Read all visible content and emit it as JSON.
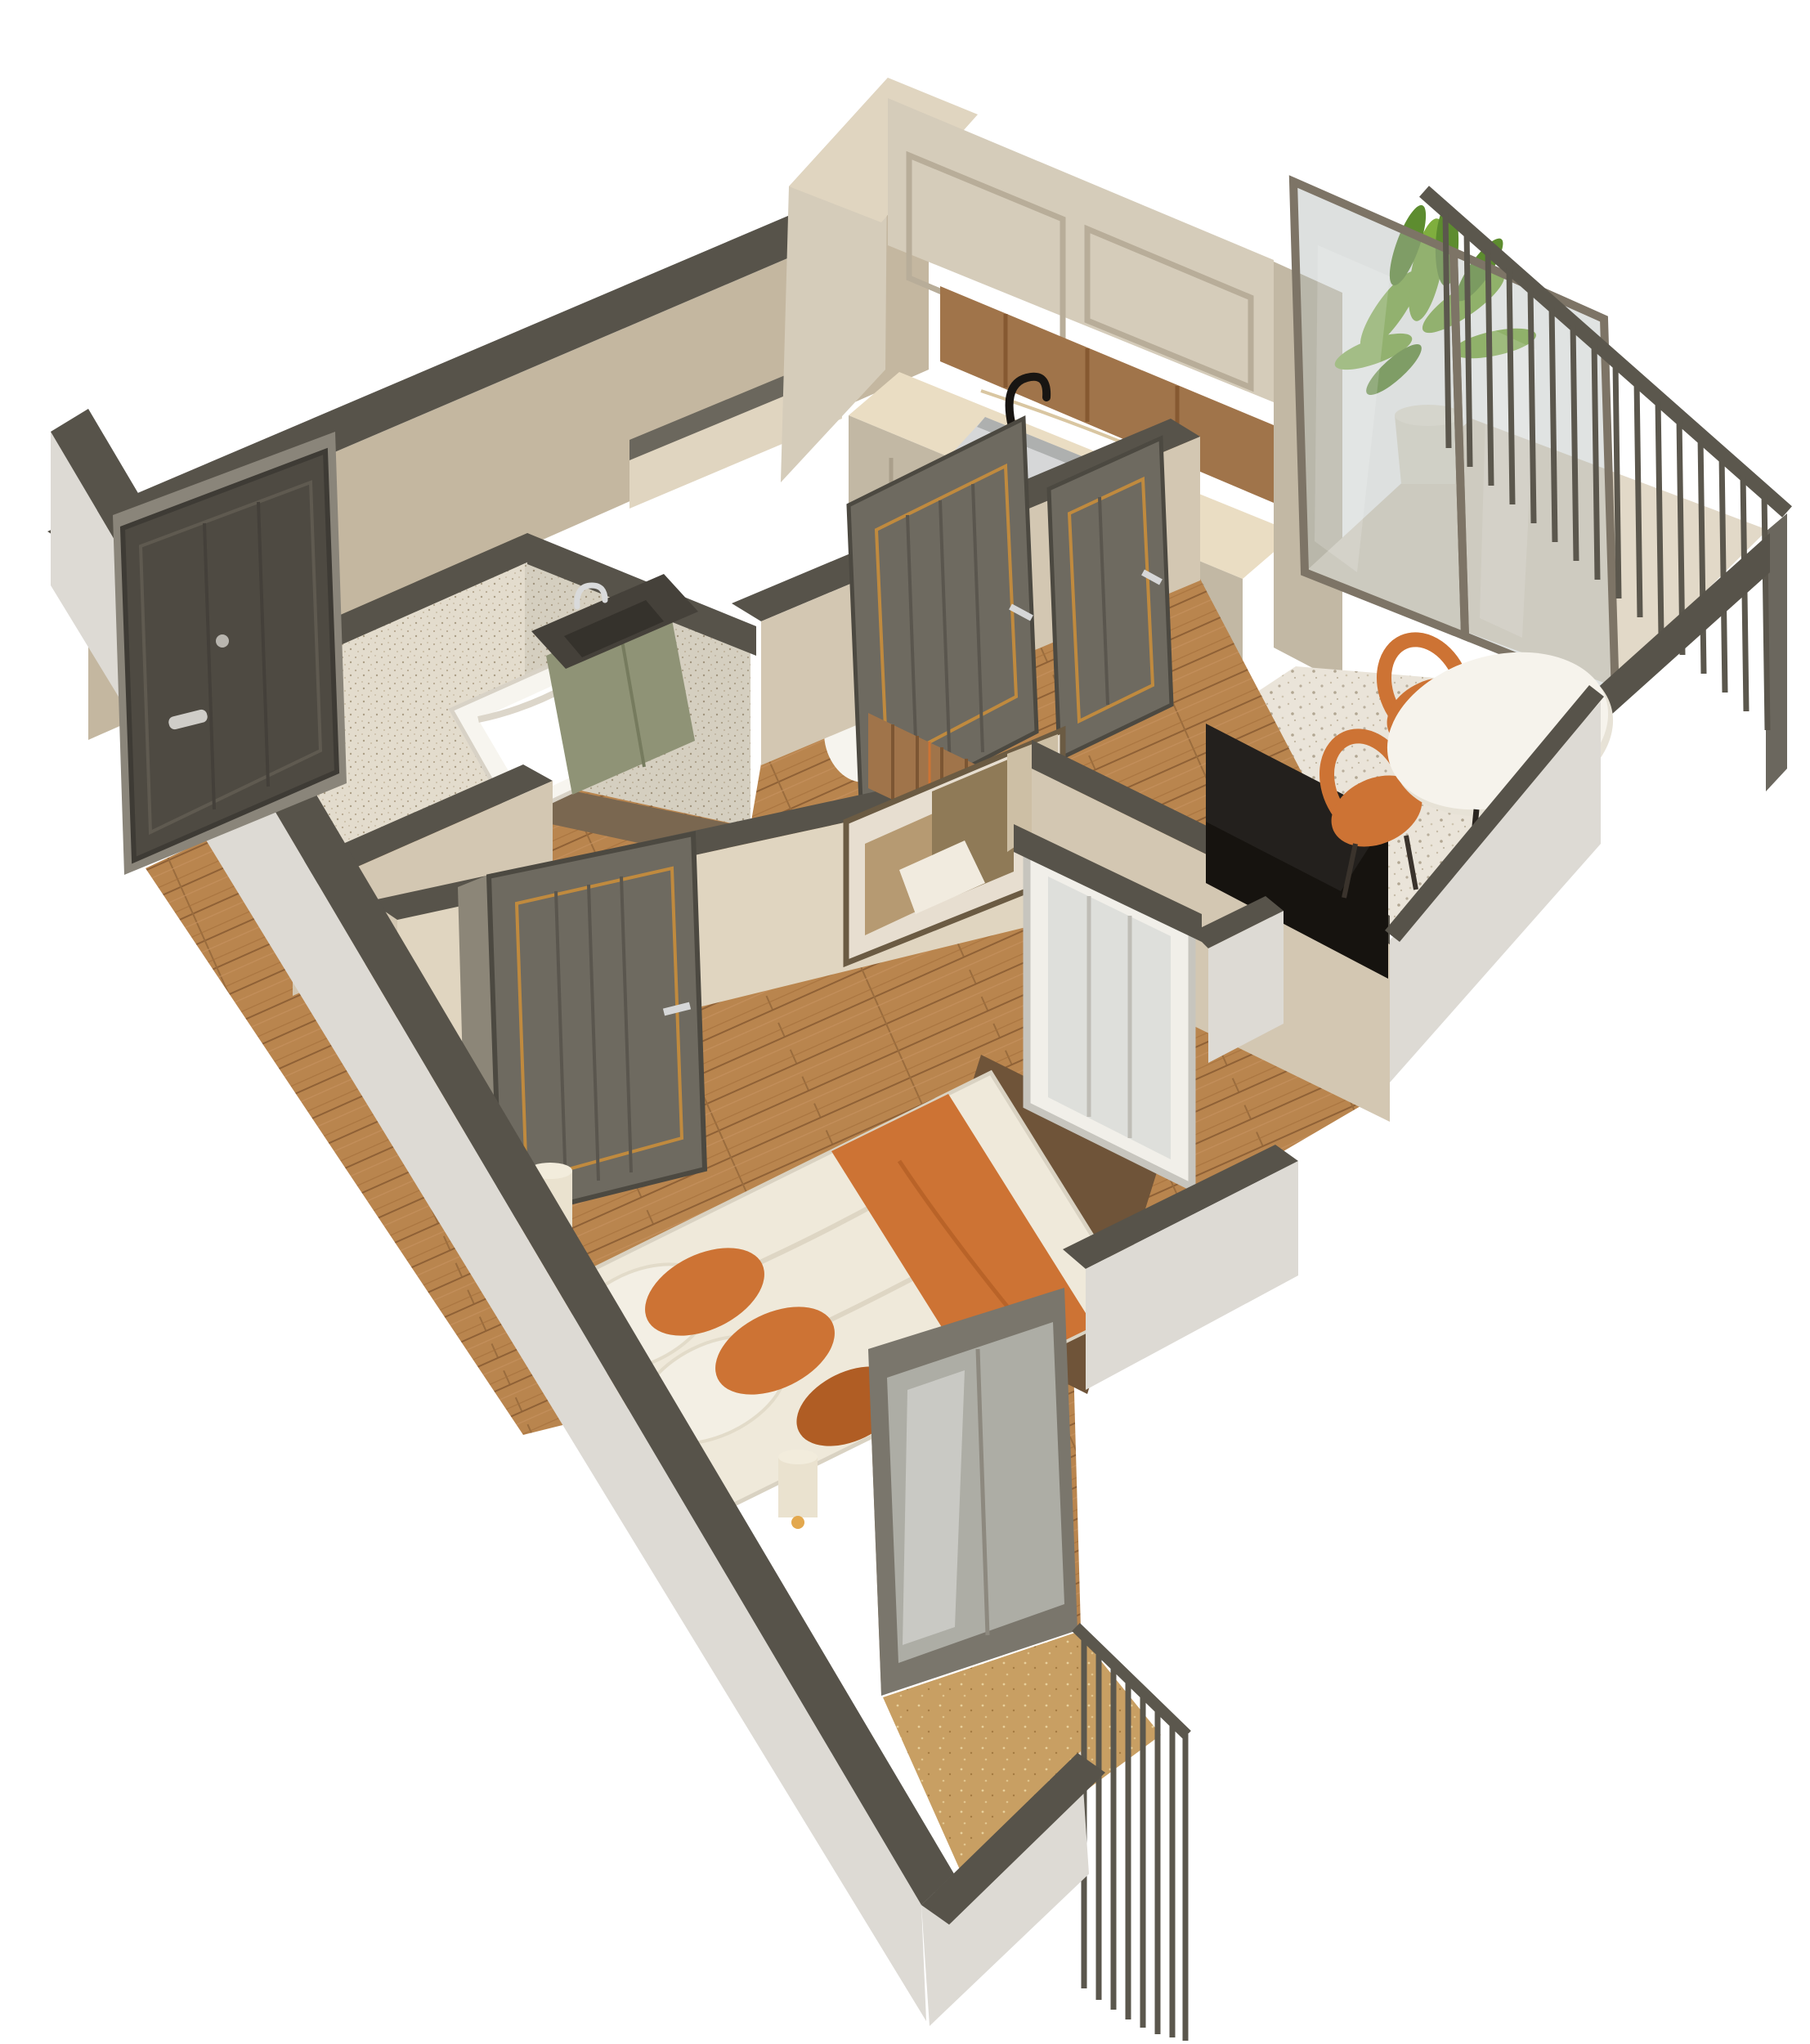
{
  "scene": {
    "kind": "3d-floor-plan-render",
    "description": "Axonometric cutaway 3D render of a one-bedroom apartment floor plan on a white background",
    "background": "#ffffff"
  },
  "colors": {
    "wallTop": "#57534a",
    "wallTopLight": "#6b675d",
    "wallCream": "#d3c7b2",
    "wallCreamShade": "#c4b7a0",
    "wallCreamLit": "#e0d5c0",
    "wallOuterWhite": "#dddad4",
    "floorWood": "#b9854e",
    "floorWoodDark": "#9a6c3d",
    "terrazzo": "#eae4d9",
    "bathTile": "#e3dccd",
    "marble": "#eaddc3",
    "cabinetCream": "#d5ccba",
    "cabinetCreamShade": "#c2b8a4",
    "woodPanel": "#a0744a",
    "doorDark": "#6e6a60",
    "doorDarkShade": "#59564d",
    "entryDoor": "#4e4a42",
    "gold": "#c08a3e",
    "chrome": "#d6d7d8",
    "orange": "#cd7334",
    "orangeDark": "#b05d24",
    "beddingWhite": "#efe9da",
    "tubWhite": "#f7f5ef",
    "vanityGreen": "#8f9376",
    "stoneDark": "#45413a",
    "tvBlack": "#16130f",
    "glassTint": "#aeb6b2",
    "frameBronze": "#7d7466",
    "frameSilver": "#c7c5be",
    "railDark": "#5b574d",
    "plantGreen": "#7fae3e",
    "plantGreenDark": "#5d8c2f",
    "potWhite": "#e9e3d5",
    "lampShade": "#ece4cf",
    "lampGlow": "#e3a84e",
    "rugBrown": "#6f5439",
    "balconyFloor": "#e2d9c8",
    "balconyWood": "#c89f63"
  },
  "rooms": [
    {
      "id": "entry-hall",
      "floor": "wood"
    },
    {
      "id": "bathroom",
      "floor": "tile",
      "fixtures": [
        "bathtub",
        "vanity",
        "faucet"
      ]
    },
    {
      "id": "wc",
      "fixtures": [
        "toilet",
        "towel-bar"
      ]
    },
    {
      "id": "kitchen",
      "fixtures": [
        "upper-cabinets",
        "wood-back-panel",
        "marble-counter",
        "sink",
        "black-faucet",
        "base-cabinets",
        "tall-cabinet"
      ]
    },
    {
      "id": "dining-area",
      "floor": "terrazzo",
      "fixtures": [
        "dining-table",
        "orange-chair-1",
        "orange-chair-2"
      ]
    },
    {
      "id": "living-area",
      "floor": "wood",
      "fixtures": [
        "tv",
        "artwork",
        "wood-slat-panel",
        "window"
      ]
    },
    {
      "id": "bedroom",
      "floor": "wood",
      "fixtures": [
        "bed",
        "orange-runner",
        "pillows",
        "lamp-1",
        "lamp-2",
        "rug",
        "glass-door"
      ]
    },
    {
      "id": "balcony-top",
      "fixtures": [
        "plant",
        "planter",
        "sliding-glass-doors",
        "railing"
      ]
    },
    {
      "id": "balcony-bottom",
      "fixtures": [
        "railing"
      ]
    }
  ],
  "doors": [
    {
      "id": "entry-door",
      "style": "dark panel, silver handle, peephole"
    },
    {
      "id": "bathroom-door",
      "style": "dark gray, gold trim, fluted"
    },
    {
      "id": "wc-door",
      "style": "dark gray, gold trim, fluted"
    },
    {
      "id": "bedroom-door",
      "style": "dark gray, gold trim, fluted"
    }
  ]
}
